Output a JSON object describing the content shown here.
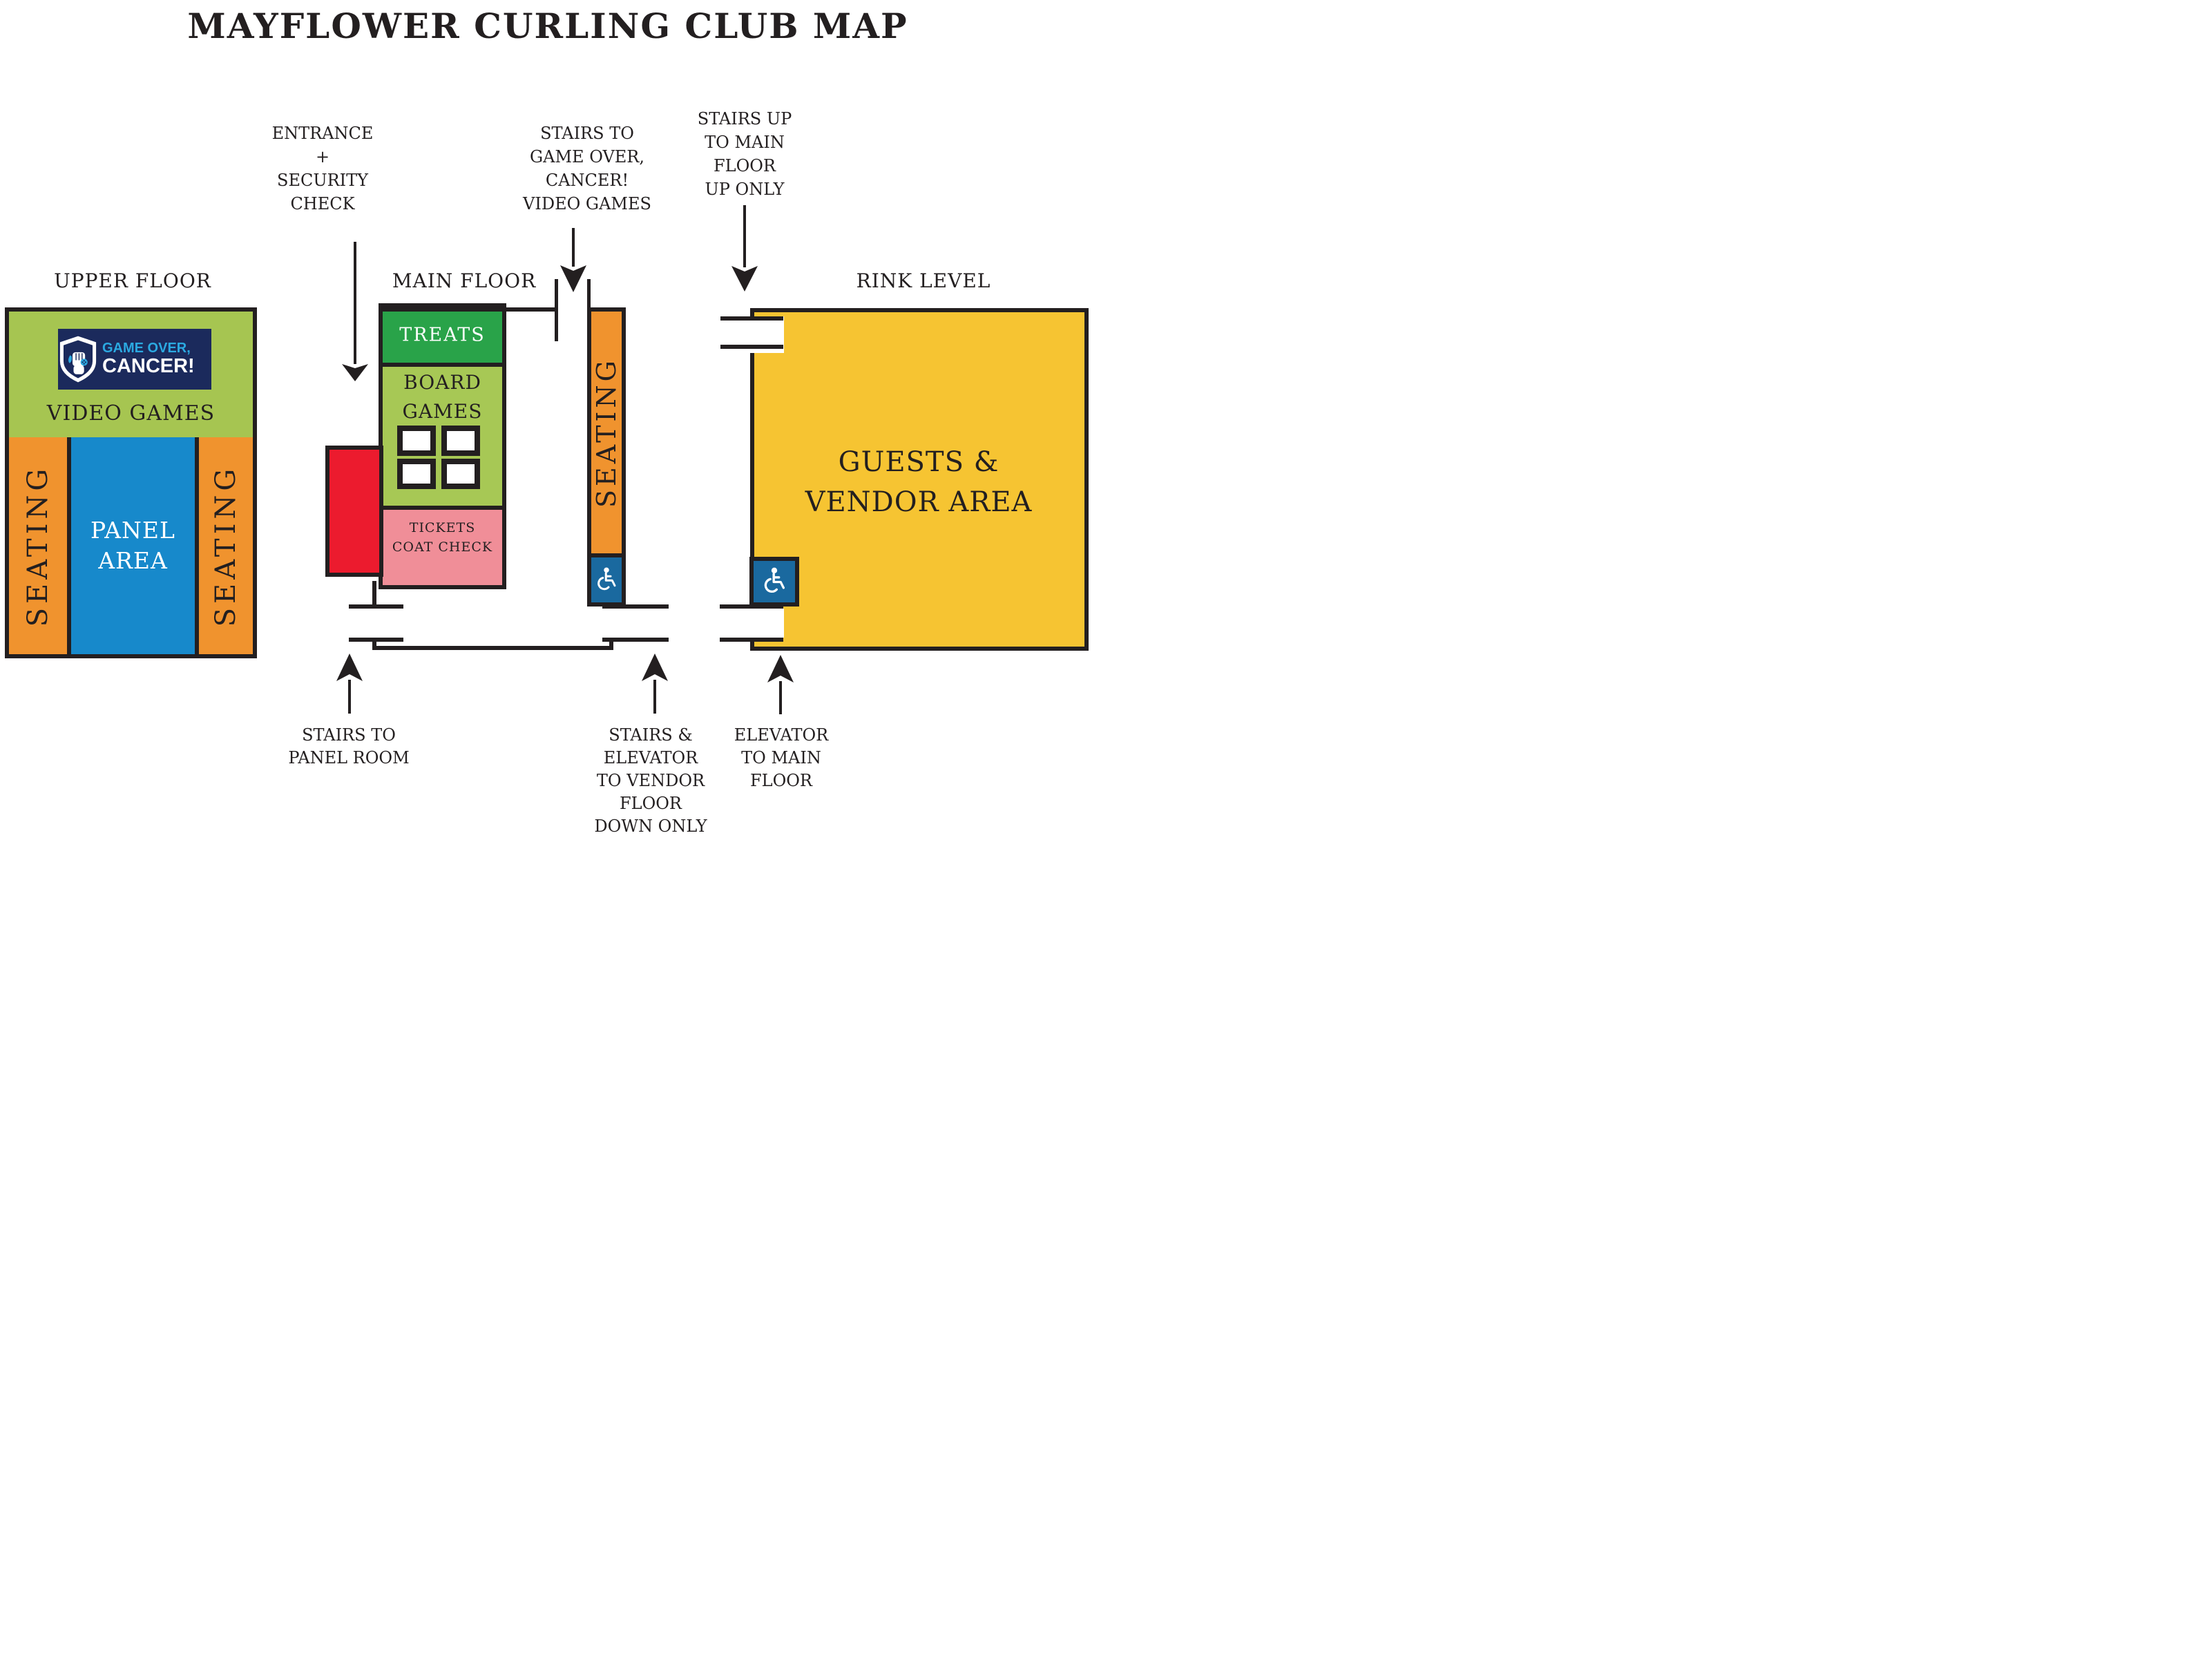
{
  "title": "MAYFLOWER CURLING CLUB MAP",
  "colors": {
    "ink": "#231f20",
    "green": "#a6c551",
    "treats_green": "#29a349",
    "orange": "#f0932e",
    "panel_blue": "#1789cb",
    "accessible_blue": "#1a699f",
    "logo_navy": "#1b2a5c",
    "logo_cyan": "#2ba9e1",
    "red": "#ec1b2e",
    "pink": "#f08e98",
    "rink_yellow": "#f6c432"
  },
  "floors": {
    "upper": {
      "label": "UPPER FLOOR",
      "logo": {
        "line1": "GAME OVER,",
        "line2": "CANCER!"
      },
      "video_games": "VIDEO GAMES",
      "seating_left": "SEATING",
      "seating_right": "SEATING",
      "panel_line1": "PANEL",
      "panel_line2": "AREA"
    },
    "main": {
      "label": "MAIN FLOOR",
      "treats": "TREATS",
      "board_line1": "BOARD",
      "board_line2": "GAMES",
      "tickets_line1": "TICKETS",
      "tickets_line2": "COAT CHECK",
      "seating": "SEATING"
    },
    "rink": {
      "label": "RINK LEVEL",
      "guests_line1": "GUESTS &",
      "guests_line2": "VENDOR AREA"
    }
  },
  "annotations": {
    "entrance": {
      "lines": [
        "ENTRANCE",
        "+",
        "SECURITY",
        "CHECK"
      ]
    },
    "stairs_goc": {
      "lines": [
        "STAIRS TO",
        "GAME OVER,",
        "CANCER!",
        "VIDEO GAMES"
      ]
    },
    "stairs_up": {
      "lines": [
        "STAIRS UP",
        "TO MAIN",
        "FLOOR",
        "UP ONLY"
      ]
    },
    "stairs_panel": {
      "lines": [
        "STAIRS TO",
        "PANEL ROOM"
      ]
    },
    "stairs_vendor": {
      "lines": [
        "STAIRS &",
        "ELEVATOR",
        "TO VENDOR",
        "FLOOR",
        "DOWN ONLY"
      ]
    },
    "elevator_main": {
      "lines": [
        "ELEVATOR",
        "TO MAIN",
        "FLOOR"
      ]
    }
  }
}
